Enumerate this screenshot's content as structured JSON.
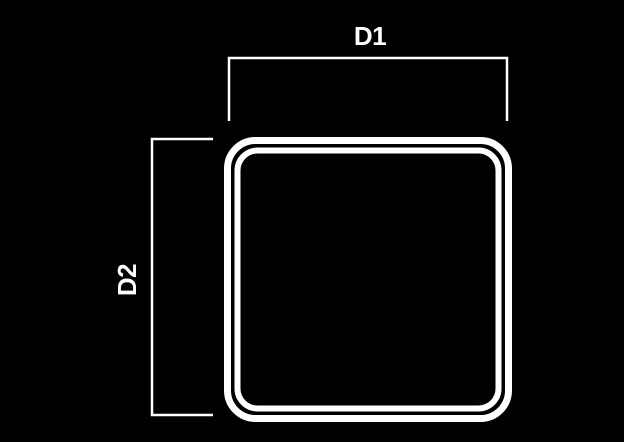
{
  "diagram": {
    "type": "technical-dimension-drawing",
    "subject": "rounded-square-profile-with-double-outline",
    "background_color": "#000000",
    "line_color": "#ffffff",
    "dimension_labels": {
      "d1": "D1",
      "d2": "D2"
    },
    "dimensions": [
      {
        "label": "D1",
        "orientation": "horizontal",
        "position": "top",
        "measures": "outer-width"
      },
      {
        "label": "D2",
        "orientation": "vertical",
        "position": "left",
        "measures": "outer-height"
      }
    ]
  }
}
